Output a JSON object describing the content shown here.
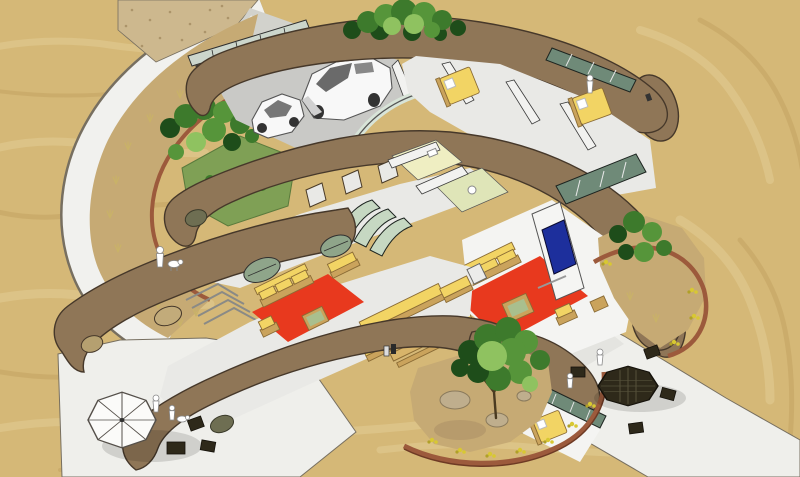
{
  "scene": {
    "type": "3d-architectural-cutaway-rendering",
    "subject": "earth-sheltered curved-wall home with cutaway roof, desert site",
    "view": "aerial axonometric"
  },
  "colors": {
    "sand": "#d5b877",
    "sandLight": "#e4cf97",
    "sandDark": "#c3a261",
    "gravel": "#cdb88e",
    "gravelDot": "#ab946a",
    "path": "#f1f1ee",
    "pathEdge": "#776f60",
    "patio": "#efefeb",
    "concrete": "#d2d2cc",
    "wall": "#8f7657",
    "wallDark": "#6e5b42",
    "outline": "#46382a",
    "soil": "#c6aa74",
    "soilDark": "#b0946a",
    "grass": "#7fa055",
    "grassDark": "#5a7a3c",
    "shrubDark": "#1e4d1a",
    "shrubMid": "#3d7a2c",
    "shrubLight": "#56953a",
    "shrubPale": "#8fc260",
    "trunk": "#4a3a20",
    "dryGrass": "#c9b268",
    "flower": "#d8c832",
    "flowerDark": "#b0a028",
    "rock": "#bfae8d",
    "rockShade": "#8a7a5c",
    "edging": "#9c5a3c",
    "edgingDark": "#6e3a24",
    "floor": "#e9e9e6",
    "floorWhite": "#f4f4f2",
    "floorYellow": "#efeec2",
    "floorGreen": "#dfe5b8",
    "partition": "#f2f2f0",
    "glassLight": "#c6d8c2",
    "glassPanel": "#6f8a78",
    "glassFrame": "#1d2420",
    "rug": "#e8391e",
    "sofa": "#f2d464",
    "sofaEdge": "#8a6b35",
    "wood": "#caa35c",
    "tableTop": "#a9bf8e",
    "tv": "#1d2f9c",
    "garageDoor": "#78876e",
    "garageFloor": "#c9c9c6",
    "vehicle": "#f8f8f8",
    "window": "#6a6a6a",
    "darkFurn": "#2e291a",
    "figure": "#ffffff",
    "figureStroke": "#8a8a8a"
  },
  "legend": [
    {
      "name": "earth-berm-walls",
      "color": "#8f7657"
    },
    {
      "name": "desert-sand",
      "color": "#d5b877"
    },
    {
      "name": "living-room-rugs",
      "color": "#e8391e"
    },
    {
      "name": "wood-furniture",
      "color": "#f2d464"
    },
    {
      "name": "tv-screen",
      "color": "#1d2f9c"
    },
    {
      "name": "glass-walls",
      "color": "#6f8a78"
    },
    {
      "name": "vegetation",
      "color": "#3d7a2c"
    },
    {
      "name": "paths-patios",
      "color": "#efefeb"
    }
  ]
}
